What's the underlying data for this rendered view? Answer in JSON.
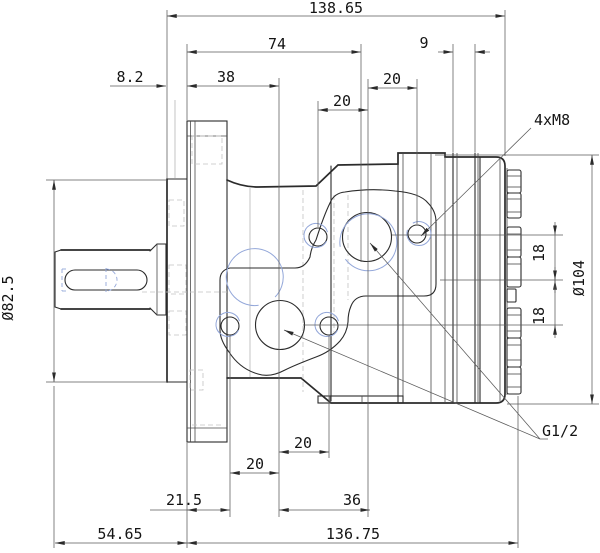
{
  "drawing": {
    "type": "engineering-dimension-drawing",
    "subject": "hydraulic-orbital-motor-side-view"
  },
  "dims": {
    "overall_top": "138.65",
    "len_74": "74",
    "len_9": "9",
    "len_8_2": "8.2",
    "len_38": "38",
    "len_20_top_right": "20",
    "len_20_top_left": "20",
    "len_20_bot_upper": "20",
    "len_20_bot_lower": "20",
    "len_21_5": "21.5",
    "len_36": "36",
    "len_54_65": "54.65",
    "len_136_75": "136.75",
    "dia_shaft_flange": "Ø82.5",
    "dia_rear": "Ø104",
    "len_18_upper": "18",
    "len_18_lower": "18"
  },
  "labels": {
    "thread_callout": "4xM8",
    "port_callout": "G1/2"
  },
  "colors": {
    "main_line": "#2b2b2b",
    "thin_line": "#4a4a4a",
    "hidden_line": "#c3c3c3",
    "thread_blue": "#93a7d9",
    "background": "#ffffff"
  }
}
